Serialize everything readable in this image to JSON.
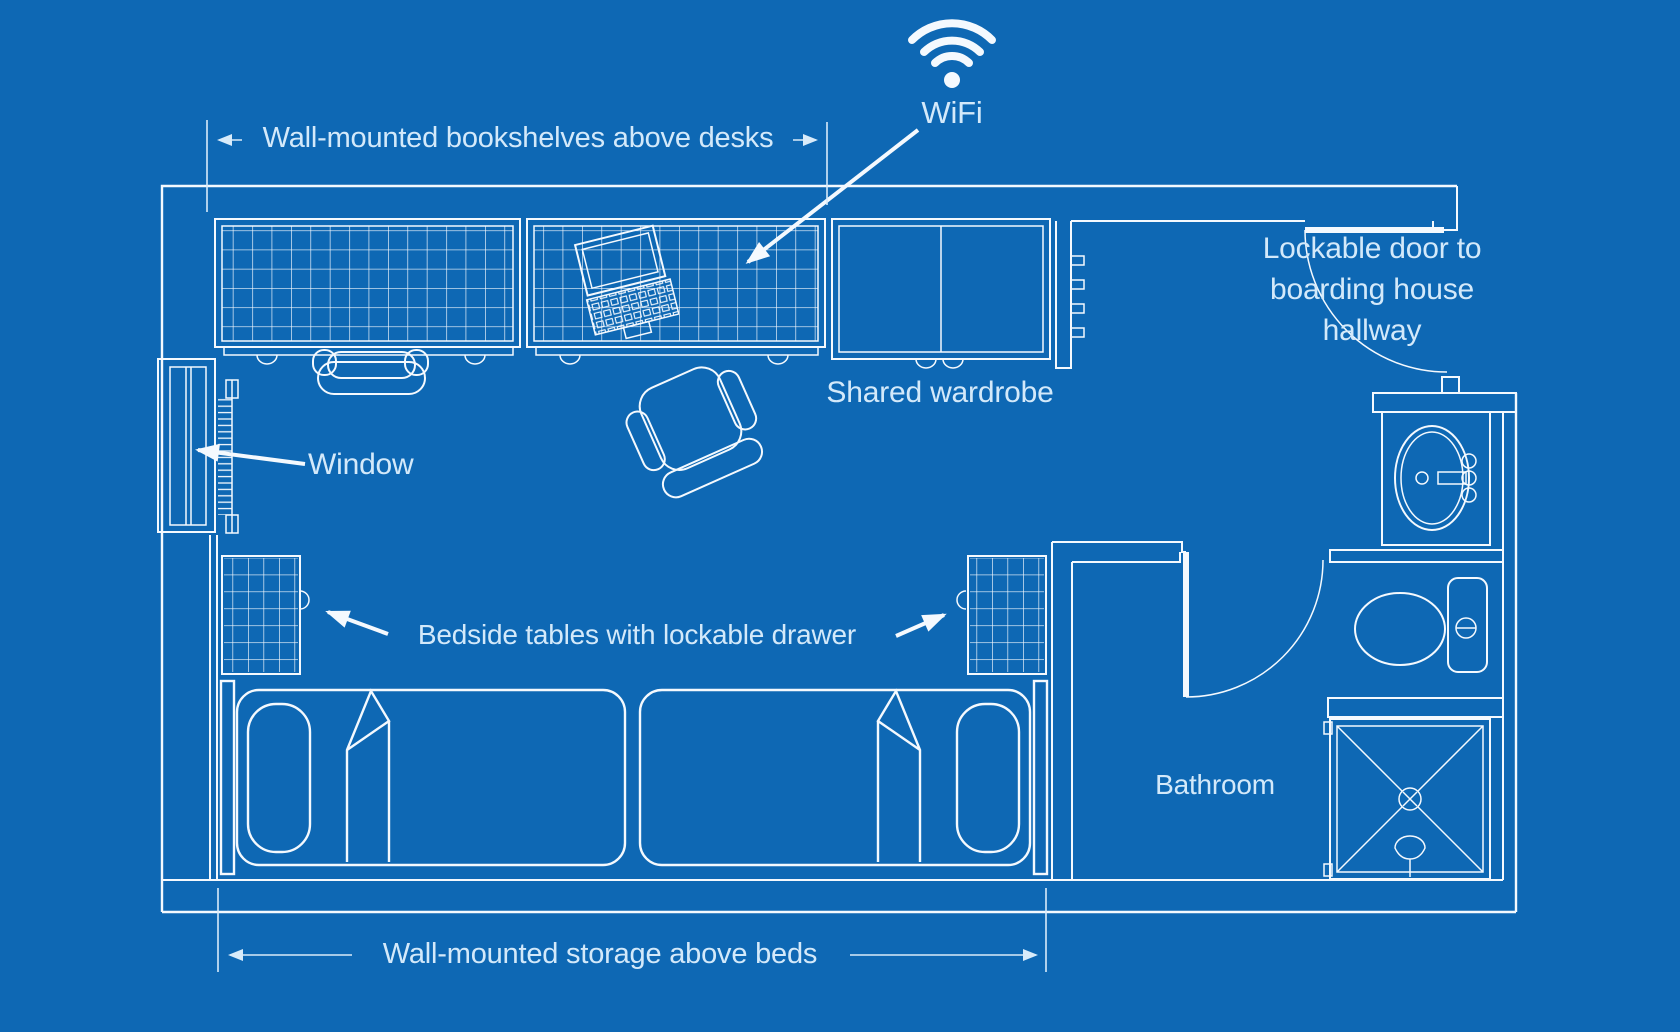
{
  "colors": {
    "background": "#0e68b4",
    "line": "#f4f9fe",
    "line_dim": "#d8ebfa",
    "text": "#d3e9fa"
  },
  "icons": {
    "wifi": "wifi-signal"
  },
  "labels": {
    "bookshelves": "Wall-mounted bookshelves above desks",
    "wifi": "WiFi",
    "door_line1": "Lockable door to",
    "door_line2": "boarding house",
    "door_line3": "hallway",
    "wardrobe": "Shared wardrobe",
    "window": "Window",
    "bedside": "Bedside tables with lockable drawer",
    "bathroom": "Bathroom",
    "storage": "Wall-mounted storage above beds"
  }
}
